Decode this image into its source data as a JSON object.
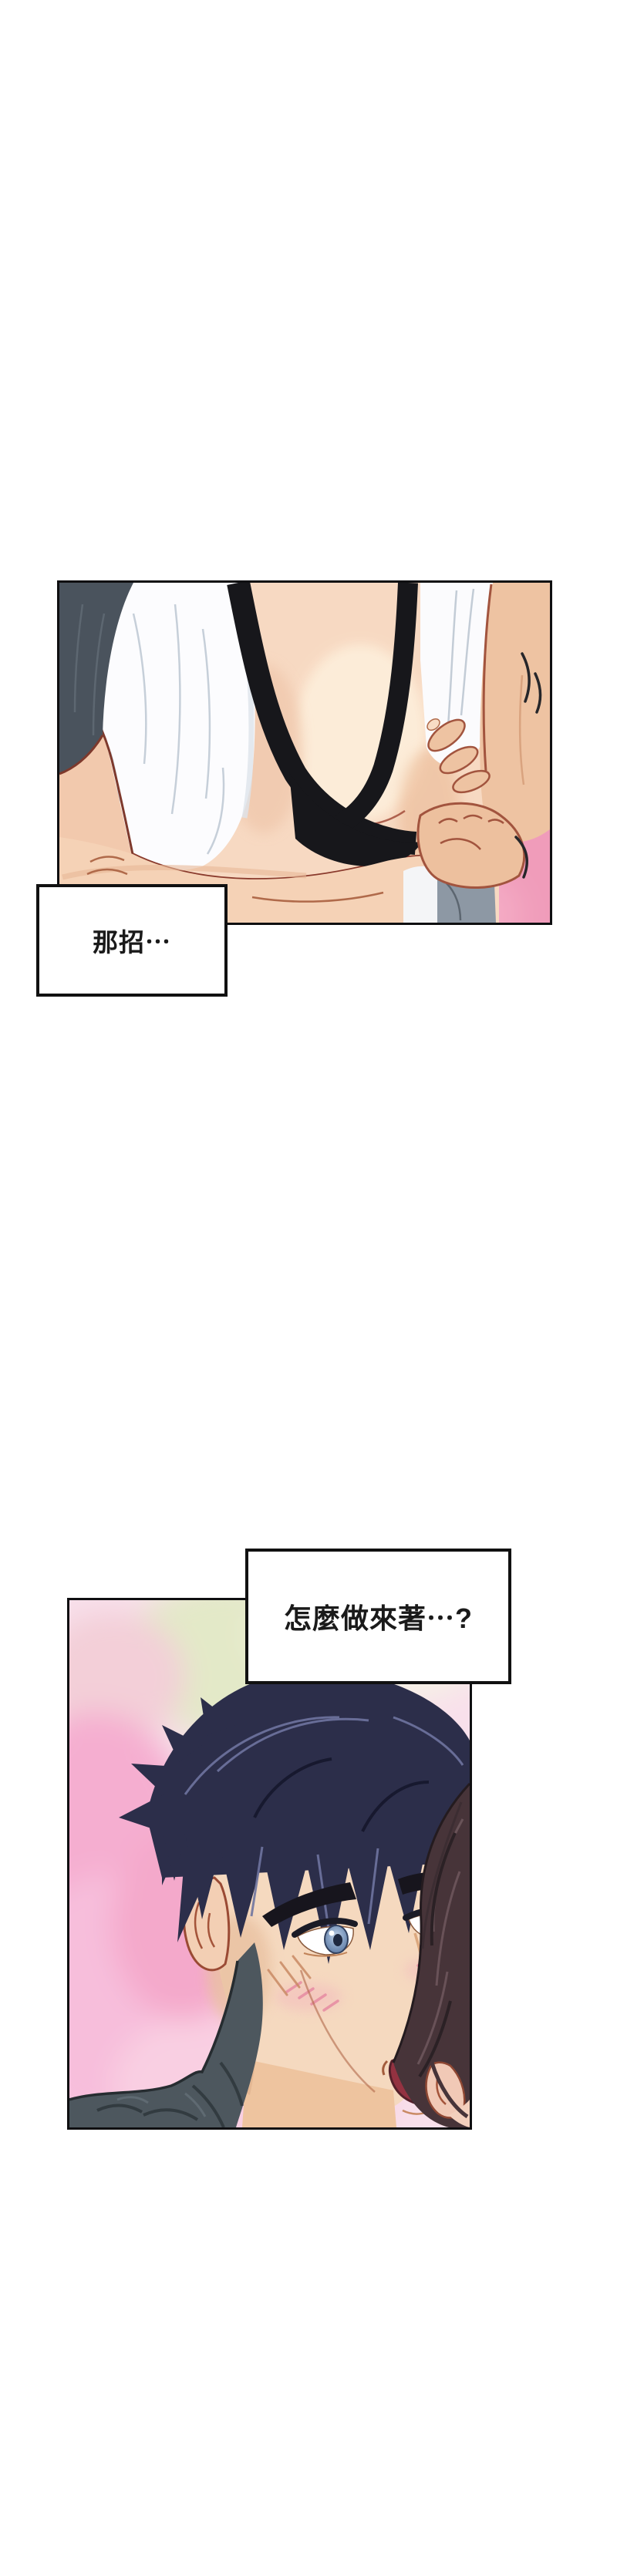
{
  "page": {
    "type": "webtoon-comic-strip",
    "background": "#ffffff"
  },
  "speech_boxes": [
    {
      "id": 1,
      "text": "那招⋯"
    },
    {
      "id": 2,
      "text": "怎麼做來著⋯?"
    }
  ],
  "colors": {
    "page_background": "#ffffff",
    "panel_border": "#0f0f11",
    "speech_box_background": "#ffffff",
    "speech_box_border": "#111111",
    "speech_text": "#1a1a1a",
    "background_pink": "#f5aed0",
    "background_green": "#d8e2b0",
    "skin_light": "#f7d9c2",
    "skin_tan": "#eec3a2",
    "outline_maroon": "#7e392c",
    "strap_black": "#17171b",
    "shirt_white": "#fcfcfe",
    "sleeve_slate": "#4a535d",
    "man_hair_navy": "#2c2e4a",
    "man_hair_highlight": "#6f74a0",
    "woman_hair_brown": "#473439",
    "eye_blue": "#8aa4c6",
    "blush_pink": "#e78fa4",
    "mouth_red": "#933241",
    "shirt_dark_gray": "#4d575e"
  }
}
